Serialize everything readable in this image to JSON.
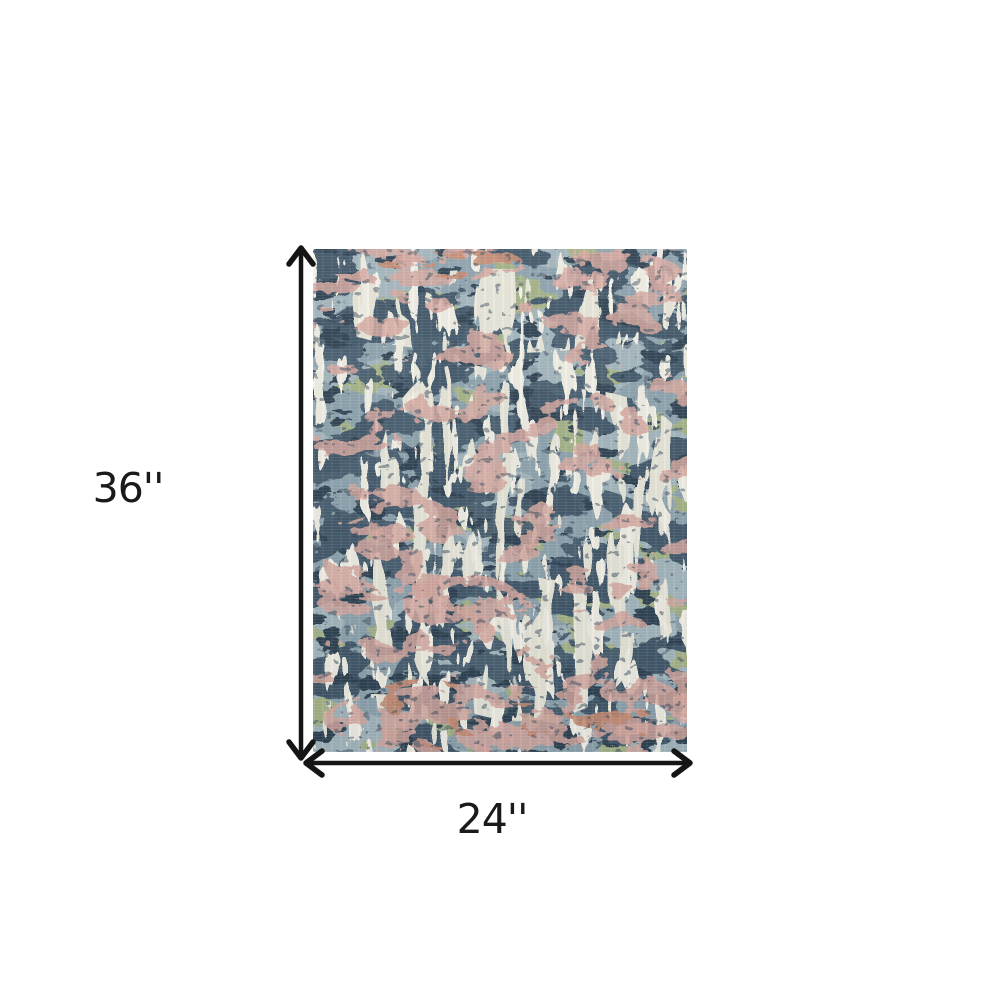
{
  "page": {
    "background_color": "#ffffff"
  },
  "diagram": {
    "type": "product-dimension-diagram",
    "height_label": "36''",
    "width_label": "24''",
    "line_color": "#151515",
    "label_color": "#1a1a1a"
  },
  "rug": {
    "name": "abstract-distressed-area-rug",
    "palette": {
      "base": "#8ca1ac",
      "wash": "#a9bbc1",
      "navy": "#3e5365",
      "deep_navy": "#2b3e4e",
      "sage": "#a6b381",
      "cream": "#eae7d9",
      "ivory": "#f3f0e5",
      "blush": "#d7a79e",
      "salmon": "#c78a70",
      "speckle": "#37485a"
    }
  }
}
